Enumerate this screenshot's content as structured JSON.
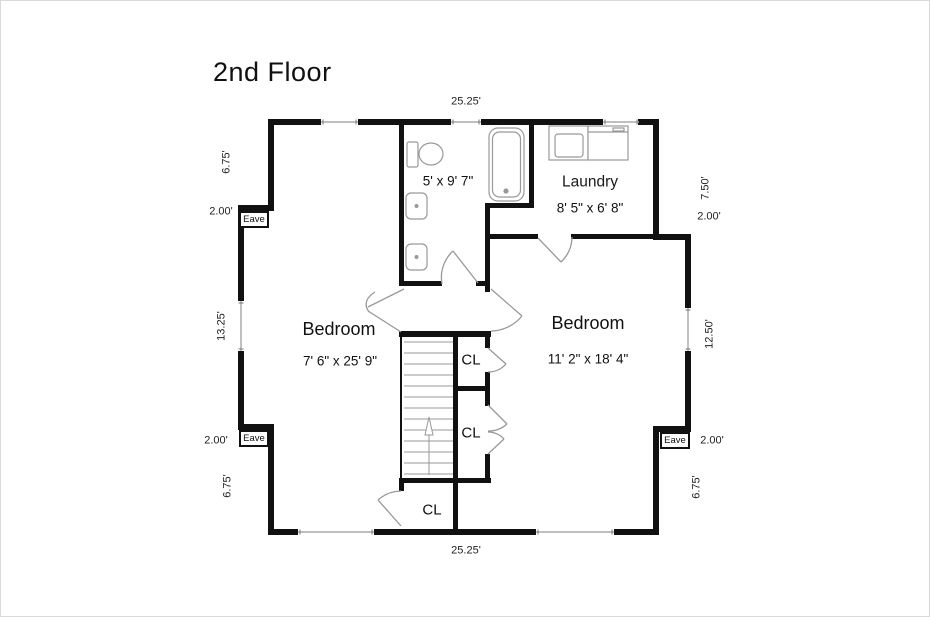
{
  "title": "2nd Floor",
  "rooms": {
    "bathroom": {
      "dims": "5' x 9' 7\""
    },
    "laundry": {
      "name": "Laundry",
      "dims": "8' 5\" x 6' 8\""
    },
    "bedroom_left": {
      "name": "Bedroom",
      "dims": "7' 6\" x 25' 9\""
    },
    "bedroom_right": {
      "name": "Bedroom",
      "dims": "11' 2\" x 18' 4\""
    },
    "closet_top": {
      "label": "CL"
    },
    "closet_middle": {
      "label": "CL"
    },
    "closet_bottom": {
      "label": "CL"
    }
  },
  "dimensions": {
    "top": "25.25'",
    "bottom": "25.25'",
    "left_top": "6.75'",
    "left_upper_jog": "2.00'",
    "left_middle": "13.25'",
    "left_lower_jog": "2.00'",
    "left_bottom": "6.75'",
    "right_top": "7.50'",
    "right_upper_jog": "2.00'",
    "right_middle": "12.50'",
    "right_lower_jog": "2.00'",
    "right_bottom": "6.75'"
  },
  "eaves": {
    "top_left": "Eave",
    "bottom_left": "Eave",
    "bottom_right": "Eave"
  },
  "colors": {
    "wall": "#111111",
    "fixture_line": "#999999",
    "window_line": "#aaaaaa",
    "background": "#ffffff"
  }
}
